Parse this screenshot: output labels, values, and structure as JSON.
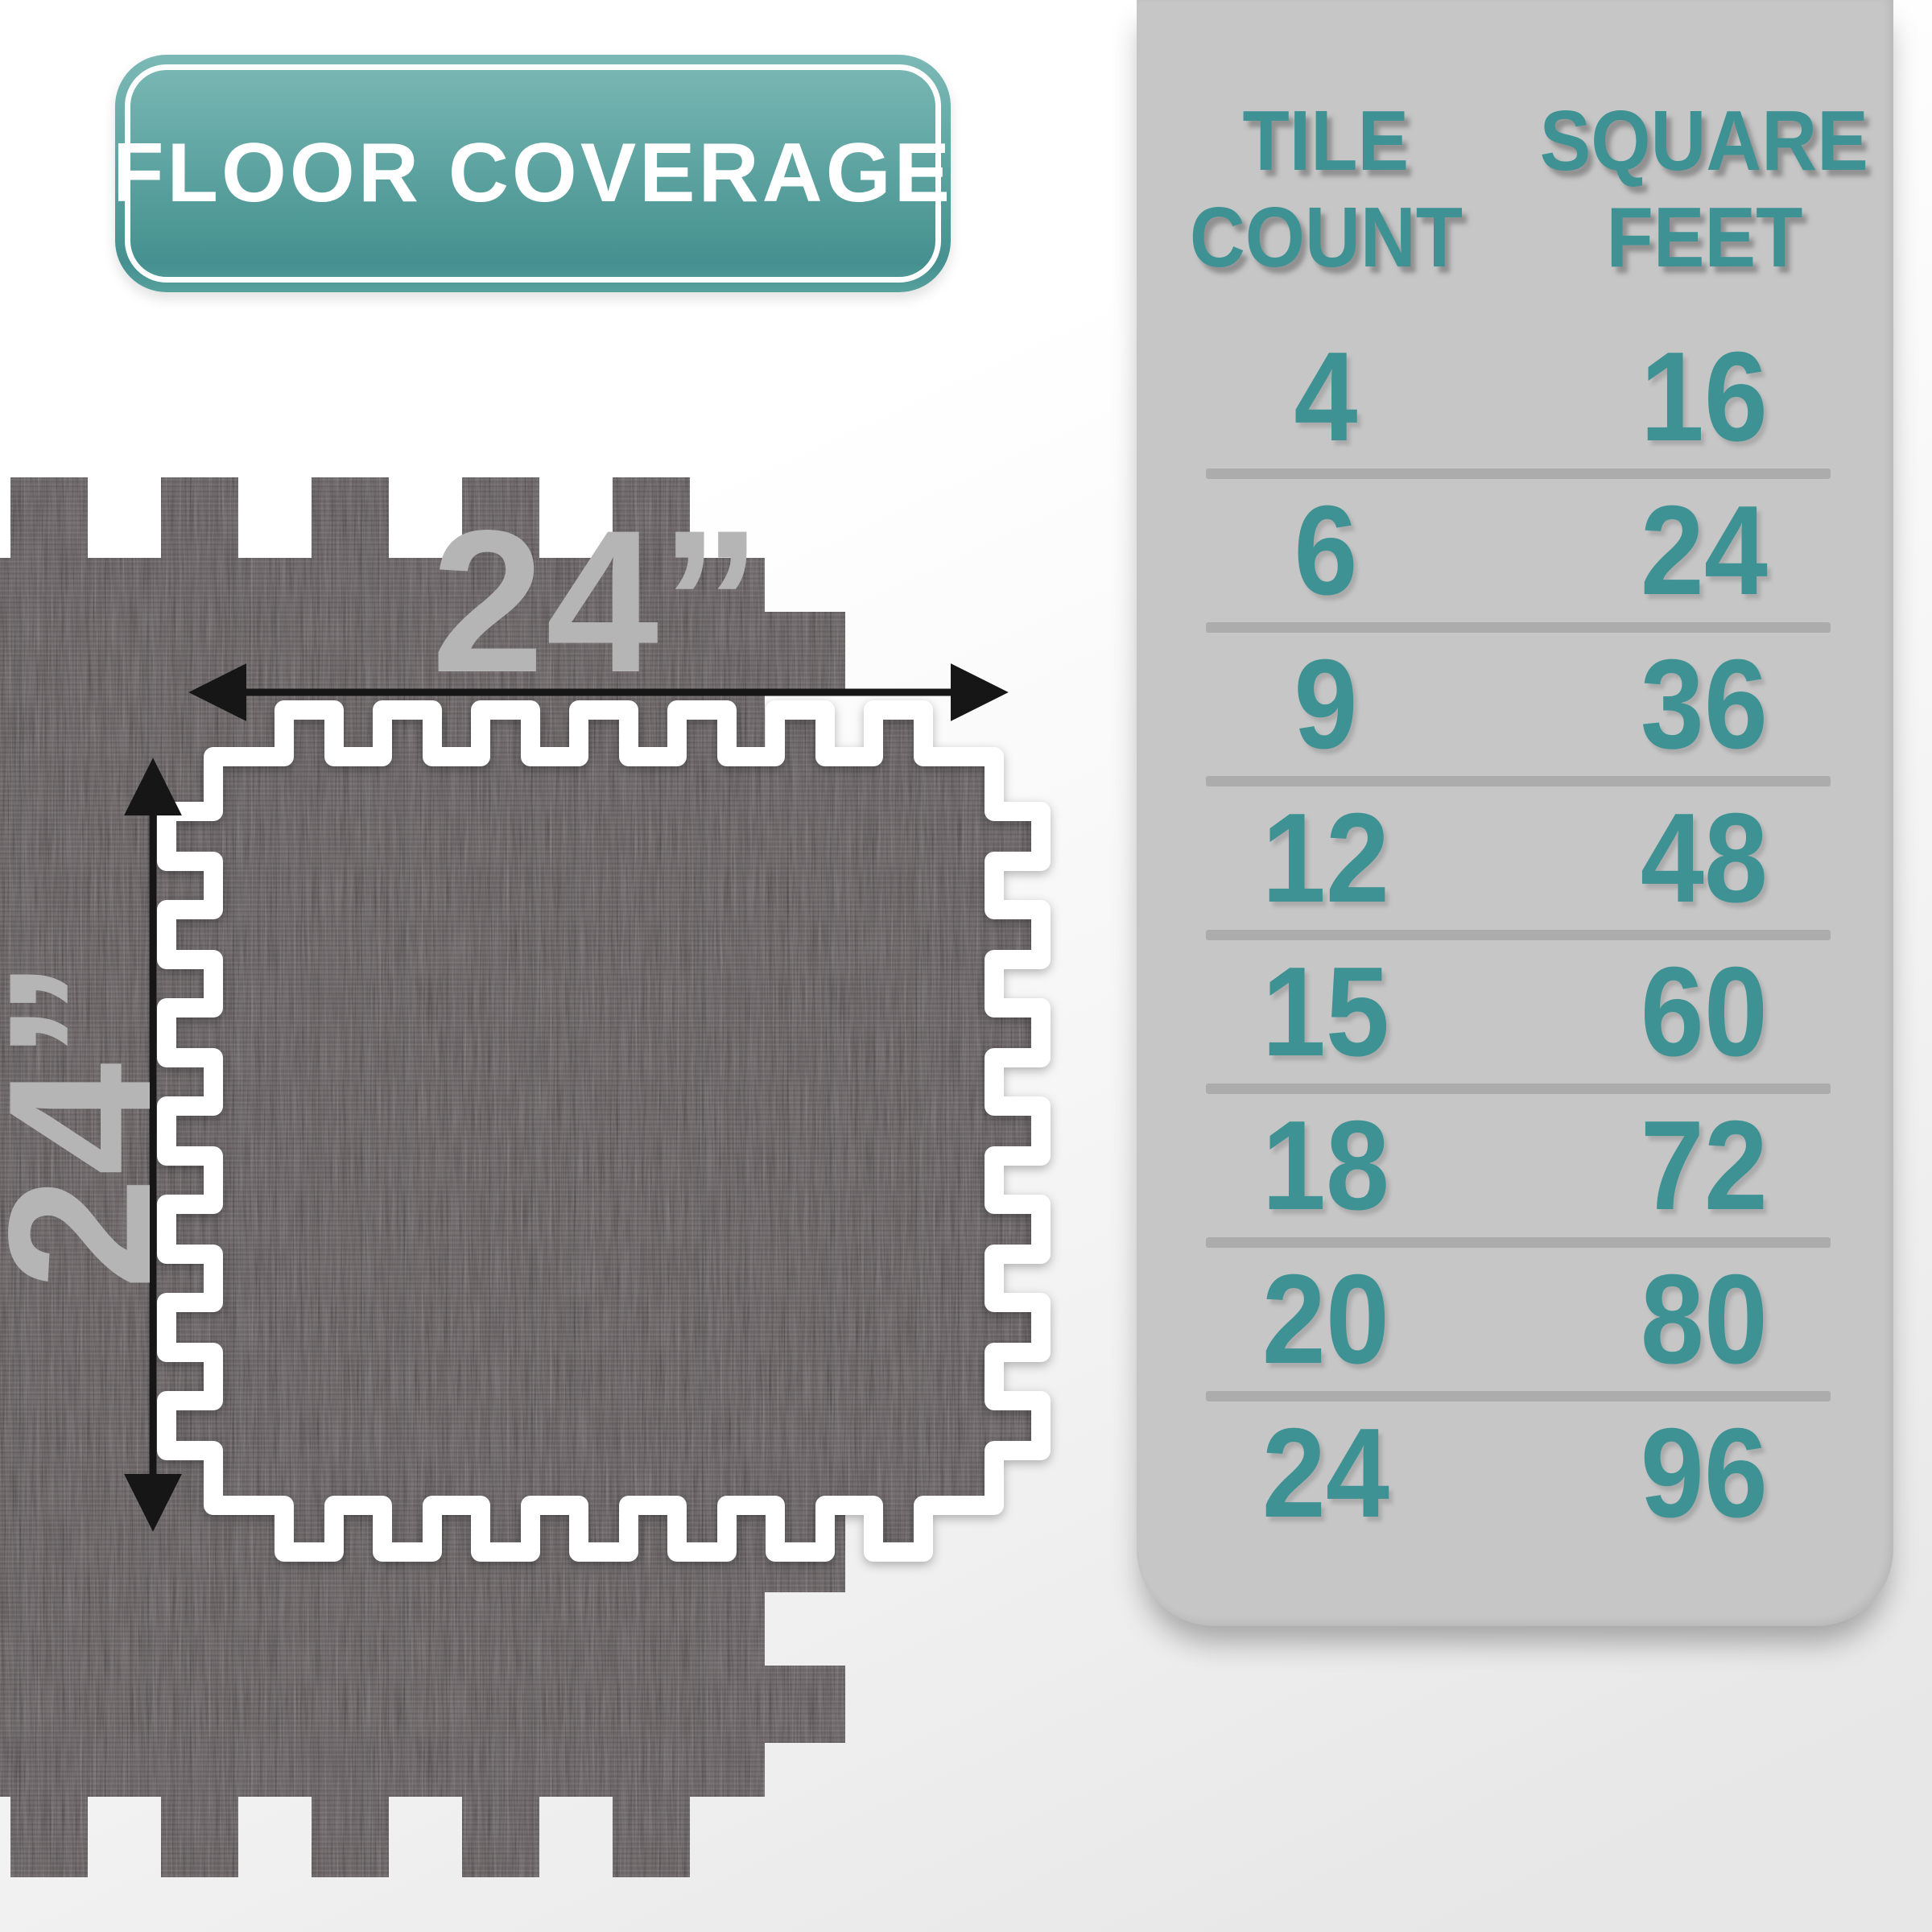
{
  "badge": {
    "label": "FLOOR COVERAGE"
  },
  "dimensions": {
    "width_label": "24”",
    "height_label": "24”"
  },
  "table": {
    "headers": [
      {
        "line1": "TILE",
        "line2": "COUNT"
      },
      {
        "line1": "SQUARE",
        "line2": "FEET"
      }
    ],
    "rows": [
      {
        "tiles": "4",
        "sqft": "16"
      },
      {
        "tiles": "6",
        "sqft": "24"
      },
      {
        "tiles": "9",
        "sqft": "36"
      },
      {
        "tiles": "12",
        "sqft": "48"
      },
      {
        "tiles": "15",
        "sqft": "60"
      },
      {
        "tiles": "18",
        "sqft": "72"
      },
      {
        "tiles": "20",
        "sqft": "80"
      },
      {
        "tiles": "24",
        "sqft": "96"
      }
    ]
  },
  "colors": {
    "teal_text": "#3e9294",
    "badge_teal": "#55a09e",
    "panel_gray": "#c6c6c6",
    "divider_gray": "#acacac",
    "dim_label_gray": "#b5b5b5",
    "arrow_black": "#161616",
    "wood_base": "#4a4143",
    "tile_border_white": "#ffffff"
  },
  "chart_data": {
    "type": "table",
    "title": "FLOOR COVERAGE",
    "columns": [
      "TILE COUNT",
      "SQUARE FEET"
    ],
    "rows": [
      [
        4,
        16
      ],
      [
        6,
        24
      ],
      [
        9,
        36
      ],
      [
        12,
        48
      ],
      [
        15,
        60
      ],
      [
        18,
        72
      ],
      [
        20,
        80
      ],
      [
        24,
        96
      ]
    ],
    "tile_size_inches": "24” x 24”"
  }
}
